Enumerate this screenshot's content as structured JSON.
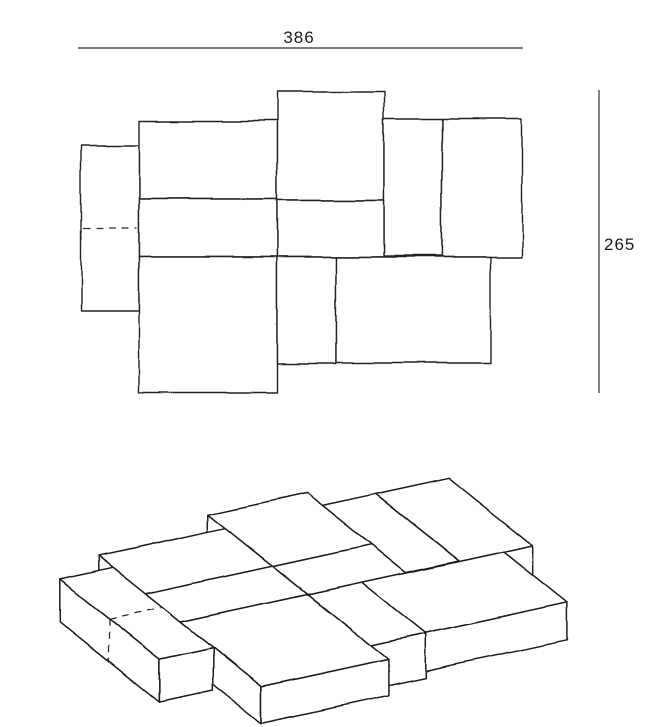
{
  "dimensions": {
    "width": "386",
    "height": "265"
  },
  "line_color": "#222222",
  "plan": {
    "blocks": [
      {
        "id": "A",
        "x": 81,
        "y": 145,
        "w": 58,
        "h": 166,
        "seam_y": 227
      },
      {
        "id": "B",
        "x": 139,
        "y": 121,
        "w": 138,
        "h": 78
      },
      {
        "id": "C",
        "x": 277,
        "y": 92,
        "w": 107,
        "h": 108
      },
      {
        "id": "D",
        "x": 384,
        "y": 118,
        "w": 58,
        "h": 138
      },
      {
        "id": "E",
        "x": 442,
        "y": 118,
        "w": 80,
        "h": 139
      },
      {
        "id": "F",
        "x": 139,
        "y": 199,
        "w": 138,
        "h": 58
      },
      {
        "id": "G",
        "x": 277,
        "y": 200,
        "w": 107,
        "h": 57
      },
      {
        "id": "H",
        "x": 139,
        "y": 257,
        "w": 138,
        "h": 136
      },
      {
        "id": "I",
        "x": 277,
        "y": 257,
        "w": 59,
        "h": 107
      },
      {
        "id": "J",
        "x": 336,
        "y": 257,
        "w": 154,
        "h": 106
      }
    ],
    "dim_top": {
      "x1": 78,
      "y": 48,
      "x2": 523,
      "label_x": 299,
      "label_y": 43
    },
    "dim_right": {
      "x": 599,
      "y1": 90,
      "y2": 393,
      "label_x": 604,
      "label_y": 250
    }
  },
  "iso": {
    "origin": [
      28,
      554
    ],
    "axis_u": [
      0.92,
      -0.2
    ],
    "axis_v": [
      0.6,
      0.48
    ],
    "plan_origin": [
      81,
      92
    ],
    "draw_order": [
      "E",
      "D",
      "C",
      "G",
      "J",
      "B",
      "I",
      "F",
      "H",
      "A"
    ],
    "heights": {
      "A": 42,
      "B": 30,
      "C": 36,
      "D": 30,
      "E": 34,
      "F": 30,
      "G": 28,
      "H": 36,
      "I": 44,
      "J": 38
    },
    "seam": {
      "block": "A",
      "plan_y": 227
    }
  }
}
